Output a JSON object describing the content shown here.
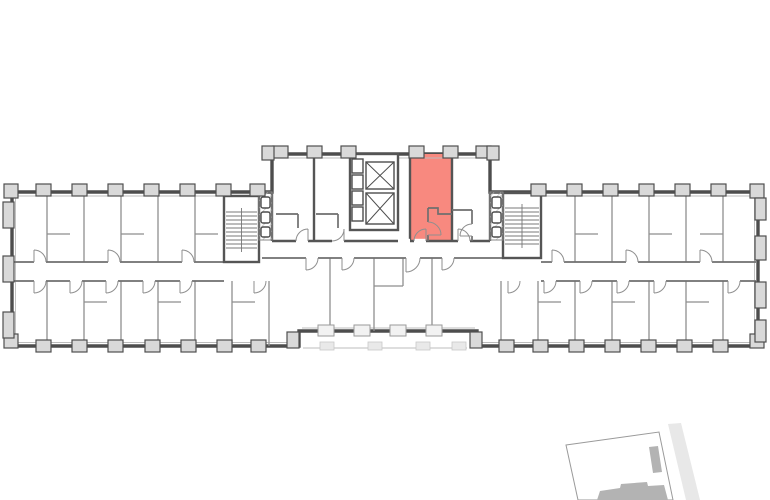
{
  "page": {
    "background": "#ffffff"
  },
  "floor_plan": {
    "kind": "apartment-building-floor-plan",
    "selected_unit": {
      "state": "selected",
      "shape": "studio-with-bathroom"
    },
    "colors": {
      "unit_highlight": "#F8897F",
      "wall_dark": "#4d4d4d",
      "wall_medium": "#555555",
      "partition": "#8e8e8e",
      "pilaster_fill": "#d9d9d9",
      "window_fill": "#f2f2f2",
      "hatch_line": "#b5b5b5"
    },
    "symbols": {
      "elevator_count": 2,
      "elevator_symbol": "crossed-box",
      "staircase_count": 2
    },
    "site_minimap": {
      "parcel_fill": "#ffffff",
      "parcel_stroke": "#9a9a9a",
      "building_fill": "#b3b3b3",
      "road_fill": "#e8e8e8"
    }
  }
}
